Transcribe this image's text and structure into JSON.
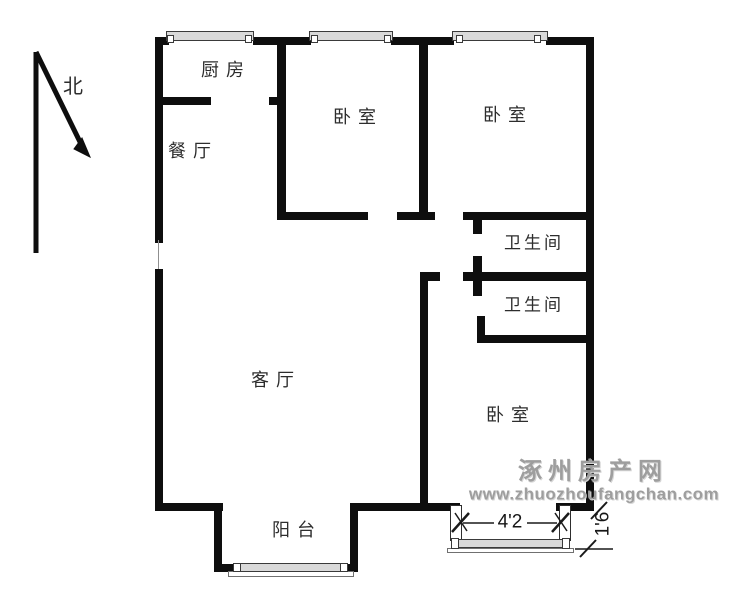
{
  "palette": {
    "wall": "#0e0e0e",
    "window_fill": "#d9d9d9",
    "label_text": "#2d2d2d",
    "watermark": "#9e9e9e",
    "background": "#ffffff"
  },
  "north": {
    "label": "北"
  },
  "rooms": {
    "kitchen": "厨房",
    "dining": "餐厅",
    "bedroom_top_left": "卧室",
    "bedroom_top_right": "卧室",
    "bath_upper": "卫生间",
    "bath_lower": "卫生间",
    "living": "客厅",
    "bedroom_bottom_right": "卧室",
    "balcony": "阳台"
  },
  "dimensions": {
    "bay_width": "4'2",
    "bay_depth": "1'6"
  },
  "watermark": {
    "site_name": "涿州房产网",
    "site_url": "www.zhuozhoufangchan.com"
  }
}
